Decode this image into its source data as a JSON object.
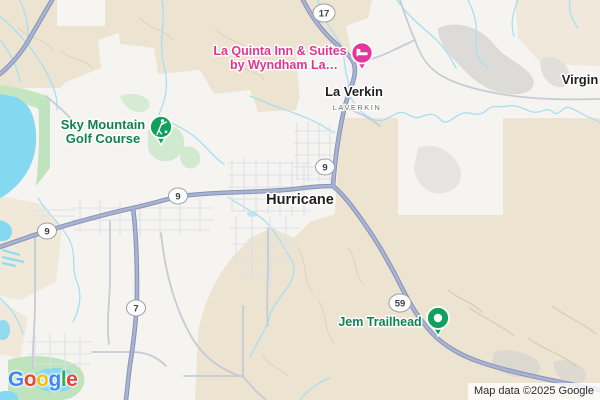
{
  "map": {
    "city_labels": [
      {
        "text": "Hurricane"
      },
      {
        "text": "La Verkin"
      },
      {
        "text": "Virgin"
      }
    ],
    "district_label": {
      "text": "LAVERKIN"
    },
    "pois": [
      {
        "line1": "La Quinta Inn & Suites",
        "line2": "by Wyndham La…",
        "category": "lodging",
        "color": "#E0368F",
        "pin_color": "#E5359B",
        "icon": "bed-icon"
      },
      {
        "line1": "Sky Mountain",
        "line2": "Golf Course",
        "category": "golf",
        "color": "#12814F",
        "pin_color": "#12A05F",
        "icon": "golfer-icon"
      },
      {
        "line1": "Jem Trailhead",
        "category": "trailhead",
        "color": "#12814F",
        "pin_color": "#12A05F",
        "icon": "trailhead-dot-icon"
      }
    ],
    "route_shields": [
      {
        "number": "17"
      },
      {
        "number": "9"
      },
      {
        "number": "9"
      },
      {
        "number": "9"
      },
      {
        "number": "7"
      },
      {
        "number": "59"
      }
    ],
    "attribution": "Map data ©2025 Google",
    "logo": {
      "letters": [
        {
          "ch": "G",
          "color": "#4285F4"
        },
        {
          "ch": "o",
          "color": "#EA4335"
        },
        {
          "ch": "o",
          "color": "#FBBC05"
        },
        {
          "ch": "g",
          "color": "#4285F4"
        },
        {
          "ch": "l",
          "color": "#34A853"
        },
        {
          "ch": "e",
          "color": "#EA4335"
        }
      ]
    },
    "colors": {
      "water": "#84D8EF",
      "stream": "#A9DEF2",
      "terrain_tan": "#ECE4D1",
      "park_green": "#C3E5C0",
      "highway_fill": "#A9B4D4",
      "highway_casing": "#8893B6",
      "local_road": "#C6CBD5",
      "street": "#DBE0E9",
      "city_text": "#1F1F1F",
      "district_text": "#6F6F6F"
    }
  }
}
